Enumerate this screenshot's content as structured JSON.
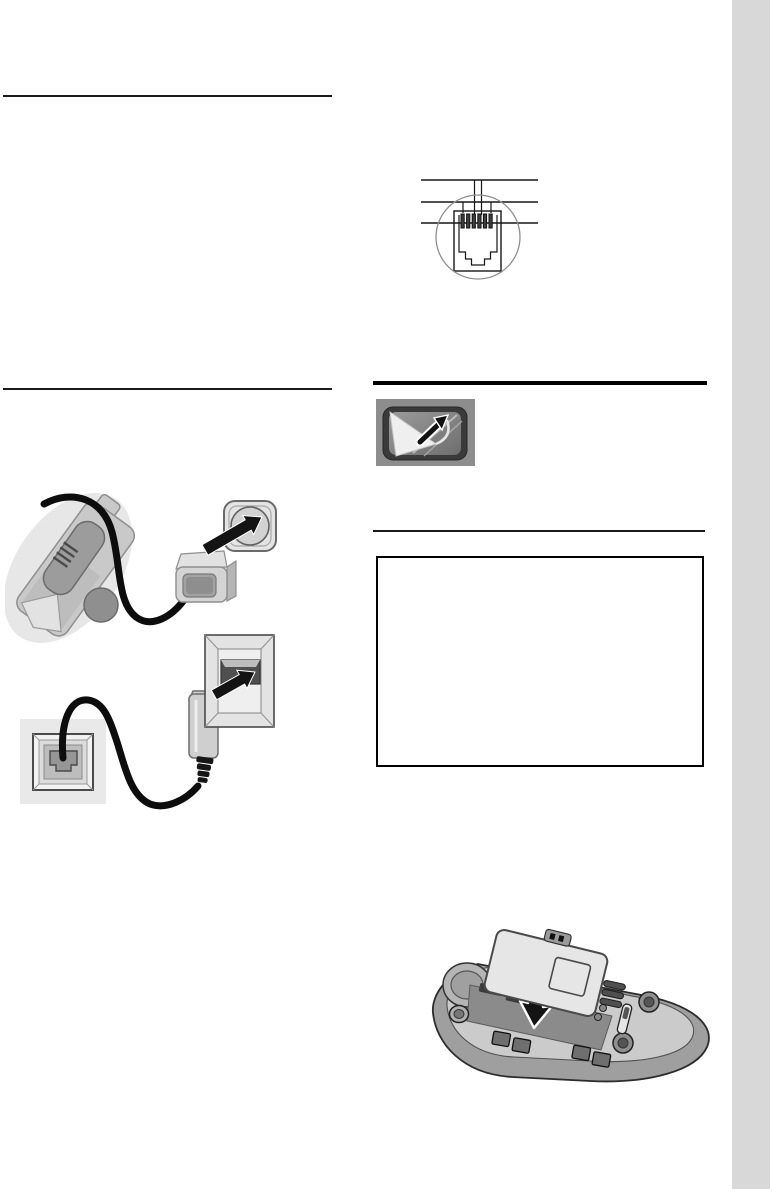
{
  "document": {
    "kind": "scanned-manual-page",
    "page_background": "#ffffff",
    "edge_tab_color": "#d8d8d8",
    "visible_text": ""
  },
  "note_box": {
    "content": "",
    "border_color": "#000000"
  },
  "figures": {
    "plug_pinout": {
      "label": "telephone-plug-pin-assignment-diagram",
      "pin_count": 6,
      "callout_line_count": 3
    },
    "display_film": {
      "label": "display-protective-film-removal",
      "background_color": "#8d8d8d",
      "bezel_color": "#3a3a3a"
    },
    "charger_power": {
      "label": "charger-cradle-power-adapter-to-mains-socket",
      "cable_color": "#0d0d0d"
    },
    "phone_cord": {
      "label": "telephone-cord-wall-jack-to-phone-plug",
      "cable_color": "#0d0d0d"
    },
    "battery_insert": {
      "label": "insert-battery-into-handset-back",
      "body_color": "#9f9f9f",
      "battery_color": "#e6e6e6"
    }
  },
  "rules": {
    "left_top": "thin-rule",
    "left_bottom": "thin-rule",
    "right_thick": "thick-rule",
    "right_thin": "thin-rule"
  }
}
